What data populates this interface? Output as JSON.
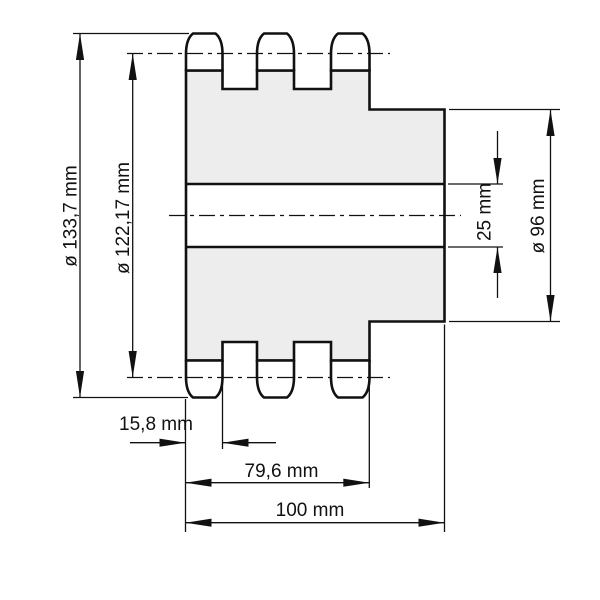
{
  "diagram": {
    "type": "technical-drawing",
    "subject": "triple-strand sprocket cross-section with dimension callouts",
    "units": "mm",
    "dimensions": {
      "tip_diameter": "ø 133,7 mm",
      "pitch_diameter": "ø 122,17 mm",
      "bore_diameter": "25 mm",
      "hub_diameter": "ø 96 mm",
      "single_row_width": "15,8 mm",
      "teeth_overall_width": "79,6 mm",
      "overall_width": "100 mm"
    },
    "colors": {
      "line": "#111111",
      "body_fill": "#ededed",
      "background": "#ffffff"
    }
  }
}
